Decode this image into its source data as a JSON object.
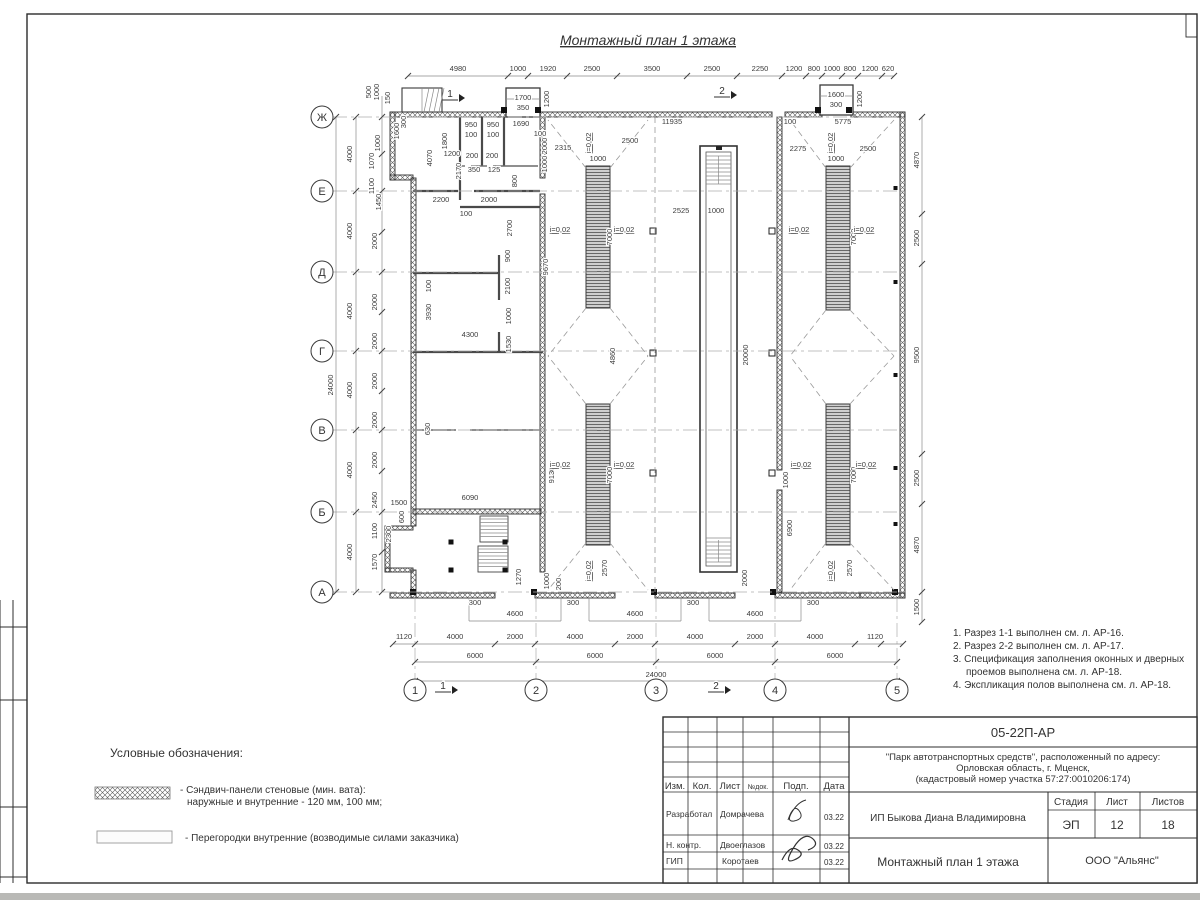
{
  "sheet": {
    "title": "Монтажный план 1 этажа"
  },
  "notes": {
    "lines": [
      "1. Разрез 1-1 выполнен см. л. АР-16.",
      "2. Разрез 2-2 выполнен см. л. АР-17.",
      "3. Спецификация заполнения оконных и дверных",
      "проемов выполнена см. л. АР-18.",
      "4. Экспликация полов выполнена см. л. АР-18."
    ]
  },
  "legend": {
    "heading": "Условные обозначения:",
    "item1_line1": "- Сэндвич-панели стеновые (мин. вата):",
    "item1_line2": "наружные и внутренние - 120 мм, 100 мм;",
    "item2": "- Перегородки внутренние (возводимые силами заказчика)"
  },
  "title_block": {
    "doc_number": "05-22П-АР",
    "project_line1": "\"Парк автотранспортных средств\",  расположенный по адресу:",
    "project_line2": "Орловская область, г. Мценск,",
    "project_line3": "(кадастровый номер участка 57:27:0010206:174)",
    "client": "ИП Быкова Диана Владимировна",
    "drawing_title": "Монтажный план 1 этажа",
    "company": "ООО \"Альянс\"",
    "col_izm": "Изм.",
    "col_kol": "Кол.",
    "col_list": "Лист",
    "col_ndok": "№док.",
    "col_podp": "Подп.",
    "col_data": "Дата",
    "row1_role": "Разработал",
    "row1_name": "Домрачева",
    "row1_date": "03.22",
    "row2_role": "Н. контр.",
    "row2_name": "Двоеглазов",
    "row2_date": "03.22",
    "row3_role": "ГИП",
    "row3_name": "Коротаев",
    "row3_date": "03.22",
    "stage_label": "Стадия",
    "sheet_label": "Лист",
    "sheets_label": "Листов",
    "stage_value": "ЭП",
    "sheet_value": "12",
    "sheets_value": "18"
  },
  "plan": {
    "slope_text": "i=0,02",
    "slope_h": [
      [
        560,
        232
      ],
      [
        624,
        232
      ],
      [
        799,
        232
      ],
      [
        864,
        232
      ],
      [
        560,
        467
      ],
      [
        624,
        467
      ],
      [
        801,
        467
      ],
      [
        866,
        467
      ]
    ],
    "slope_v": [
      [
        591,
        143
      ],
      [
        833,
        143
      ],
      [
        591,
        571
      ],
      [
        833,
        571
      ]
    ],
    "axes_left": [
      {
        "l": "Ж",
        "y": 117
      },
      {
        "l": "Е",
        "y": 191
      },
      {
        "l": "Д",
        "y": 272
      },
      {
        "l": "Г",
        "y": 351
      },
      {
        "l": "В",
        "y": 430
      },
      {
        "l": "Б",
        "y": 512
      },
      {
        "l": "А",
        "y": 592
      }
    ],
    "axes_bottom": [
      {
        "l": "1",
        "x": 415
      },
      {
        "l": "2",
        "x": 536
      },
      {
        "l": "3",
        "x": 656
      },
      {
        "l": "4",
        "x": 775
      },
      {
        "l": "5",
        "x": 897
      }
    ],
    "section_marks": [
      {
        "l": "1",
        "x": 450,
        "y": 97
      },
      {
        "l": "2",
        "x": 722,
        "y": 94
      },
      {
        "l": "1",
        "x": 443,
        "y": 689
      },
      {
        "l": "2",
        "x": 716,
        "y": 689
      }
    ],
    "dims": [
      {
        "t": "4980",
        "x": 458,
        "y": 71
      },
      {
        "t": "1000",
        "x": 518,
        "y": 71
      },
      {
        "t": "1920",
        "x": 548,
        "y": 71
      },
      {
        "t": "2500",
        "x": 592,
        "y": 71
      },
      {
        "t": "3500",
        "x": 652,
        "y": 71
      },
      {
        "t": "2500",
        "x": 712,
        "y": 71
      },
      {
        "t": "2250",
        "x": 760,
        "y": 71
      },
      {
        "t": "1200",
        "x": 794,
        "y": 71
      },
      {
        "t": "800",
        "x": 814,
        "y": 71
      },
      {
        "t": "1000",
        "x": 832,
        "y": 71
      },
      {
        "t": "800",
        "x": 850,
        "y": 71
      },
      {
        "t": "1200",
        "x": 870,
        "y": 71
      },
      {
        "t": "620",
        "x": 888,
        "y": 71
      },
      {
        "t": "1700",
        "x": 523,
        "y": 100
      },
      {
        "t": "350",
        "x": 523,
        "y": 110
      },
      {
        "t": "1200",
        "x": 549,
        "y": 99,
        "v": 1
      },
      {
        "t": "1600",
        "x": 836,
        "y": 97
      },
      {
        "t": "300",
        "x": 836,
        "y": 107
      },
      {
        "t": "1200",
        "x": 862,
        "y": 99,
        "v": 1
      },
      {
        "t": "500",
        "x": 371,
        "y": 92,
        "v": 1
      },
      {
        "t": "1000",
        "x": 379,
        "y": 92,
        "v": 1
      },
      {
        "t": "150",
        "x": 390,
        "y": 98,
        "v": 1
      },
      {
        "t": "1600",
        "x": 399,
        "y": 131,
        "v": 1
      },
      {
        "t": "300",
        "x": 406,
        "y": 122,
        "v": 1
      },
      {
        "t": "1000",
        "x": 380,
        "y": 143,
        "v": 1
      },
      {
        "t": "1070",
        "x": 374,
        "y": 161,
        "v": 1
      },
      {
        "t": "1100",
        "x": 374,
        "y": 186,
        "v": 1
      },
      {
        "t": "1450",
        "x": 381,
        "y": 202,
        "v": 1
      },
      {
        "t": "1200",
        "x": 452,
        "y": 156
      },
      {
        "t": "24000",
        "x": 333,
        "y": 385,
        "v": 1
      },
      {
        "t": "4000",
        "x": 352,
        "y": 154,
        "v": 1
      },
      {
        "t": "4000",
        "x": 352,
        "y": 231,
        "v": 1
      },
      {
        "t": "4000",
        "x": 352,
        "y": 311,
        "v": 1
      },
      {
        "t": "4000",
        "x": 352,
        "y": 390,
        "v": 1
      },
      {
        "t": "4000",
        "x": 352,
        "y": 470,
        "v": 1
      },
      {
        "t": "4000",
        "x": 352,
        "y": 552,
        "v": 1
      },
      {
        "t": "2000",
        "x": 377,
        "y": 241,
        "v": 1
      },
      {
        "t": "2000",
        "x": 377,
        "y": 302,
        "v": 1
      },
      {
        "t": "2000",
        "x": 377,
        "y": 341,
        "v": 1
      },
      {
        "t": "2000",
        "x": 377,
        "y": 381,
        "v": 1
      },
      {
        "t": "2000",
        "x": 377,
        "y": 420,
        "v": 1
      },
      {
        "t": "2000",
        "x": 377,
        "y": 460,
        "v": 1
      },
      {
        "t": "2450",
        "x": 377,
        "y": 500,
        "v": 1
      },
      {
        "t": "1100",
        "x": 377,
        "y": 531,
        "v": 1
      },
      {
        "t": "1570",
        "x": 377,
        "y": 562,
        "v": 1
      },
      {
        "t": "1500",
        "x": 399,
        "y": 505
      },
      {
        "t": "2300",
        "x": 391,
        "y": 534,
        "v": 1
      },
      {
        "t": "600",
        "x": 404,
        "y": 517,
        "v": 1
      },
      {
        "t": "4870",
        "x": 919,
        "y": 160,
        "v": 1
      },
      {
        "t": "2500",
        "x": 919,
        "y": 238,
        "v": 1
      },
      {
        "t": "9500",
        "x": 919,
        "y": 355,
        "v": 1
      },
      {
        "t": "2500",
        "x": 919,
        "y": 478,
        "v": 1
      },
      {
        "t": "4870",
        "x": 919,
        "y": 545,
        "v": 1
      },
      {
        "t": "1500",
        "x": 919,
        "y": 607,
        "v": 1
      },
      {
        "t": "300",
        "x": 475,
        "y": 605
      },
      {
        "t": "300",
        "x": 573,
        "y": 605
      },
      {
        "t": "300",
        "x": 693,
        "y": 605
      },
      {
        "t": "300",
        "x": 813,
        "y": 605
      },
      {
        "t": "4600",
        "x": 515,
        "y": 616
      },
      {
        "t": "4600",
        "x": 635,
        "y": 616
      },
      {
        "t": "4600",
        "x": 755,
        "y": 616
      },
      {
        "t": "1120",
        "x": 404,
        "y": 639
      },
      {
        "t": "4000",
        "x": 455,
        "y": 639
      },
      {
        "t": "2000",
        "x": 515,
        "y": 639
      },
      {
        "t": "4000",
        "x": 575,
        "y": 639
      },
      {
        "t": "2000",
        "x": 635,
        "y": 639
      },
      {
        "t": "4000",
        "x": 695,
        "y": 639
      },
      {
        "t": "2000",
        "x": 755,
        "y": 639
      },
      {
        "t": "4000",
        "x": 815,
        "y": 639
      },
      {
        "t": "1120",
        "x": 875,
        "y": 639
      },
      {
        "t": "6000",
        "x": 475,
        "y": 658
      },
      {
        "t": "6000",
        "x": 595,
        "y": 658
      },
      {
        "t": "6000",
        "x": 715,
        "y": 658
      },
      {
        "t": "6000",
        "x": 835,
        "y": 658
      },
      {
        "t": "24000",
        "x": 656,
        "y": 677
      },
      {
        "t": "11935",
        "x": 672,
        "y": 124
      },
      {
        "t": "100",
        "x": 790,
        "y": 124
      },
      {
        "t": "5775",
        "x": 843,
        "y": 124
      },
      {
        "t": "2315",
        "x": 563,
        "y": 150
      },
      {
        "t": "2500",
        "x": 630,
        "y": 143
      },
      {
        "t": "2275",
        "x": 798,
        "y": 151
      },
      {
        "t": "2500",
        "x": 868,
        "y": 151
      },
      {
        "t": "1000",
        "x": 598,
        "y": 161
      },
      {
        "t": "1000",
        "x": 836,
        "y": 161
      },
      {
        "t": "2525",
        "x": 681,
        "y": 213
      },
      {
        "t": "1000",
        "x": 716,
        "y": 213
      },
      {
        "t": "4860",
        "x": 615,
        "y": 356,
        "v": 1
      },
      {
        "t": "7000",
        "x": 612,
        "y": 237,
        "v": 1
      },
      {
        "t": "7000",
        "x": 612,
        "y": 475,
        "v": 1
      },
      {
        "t": "2570",
        "x": 607,
        "y": 568,
        "v": 1
      },
      {
        "t": "7000",
        "x": 856,
        "y": 237,
        "v": 1
      },
      {
        "t": "7000",
        "x": 856,
        "y": 475,
        "v": 1
      },
      {
        "t": "2570",
        "x": 852,
        "y": 568,
        "v": 1
      },
      {
        "t": "9130",
        "x": 554,
        "y": 475,
        "v": 1
      },
      {
        "t": "9670",
        "x": 548,
        "y": 267,
        "v": 1
      },
      {
        "t": "6900",
        "x": 792,
        "y": 528,
        "v": 1
      },
      {
        "t": "1000",
        "x": 788,
        "y": 480,
        "v": 1
      },
      {
        "t": "20000",
        "x": 748,
        "y": 355,
        "v": 1
      },
      {
        "t": "2000",
        "x": 747,
        "y": 578,
        "v": 1
      },
      {
        "t": "1270",
        "x": 521,
        "y": 577,
        "v": 1
      },
      {
        "t": "1000",
        "x": 549,
        "y": 581,
        "v": 1
      },
      {
        "t": "200",
        "x": 561,
        "y": 584,
        "v": 1
      },
      {
        "t": "6090",
        "x": 470,
        "y": 500
      },
      {
        "t": "4300",
        "x": 470,
        "y": 337
      },
      {
        "t": "2100",
        "x": 510,
        "y": 286,
        "v": 1
      },
      {
        "t": "1000",
        "x": 511,
        "y": 316,
        "v": 1
      },
      {
        "t": "1530",
        "x": 511,
        "y": 344,
        "v": 1
      },
      {
        "t": "900",
        "x": 510,
        "y": 256,
        "v": 1
      },
      {
        "t": "3930",
        "x": 431,
        "y": 312,
        "v": 1
      },
      {
        "t": "100",
        "x": 431,
        "y": 286,
        "v": 1
      },
      {
        "t": "630",
        "x": 430,
        "y": 429,
        "v": 1
      },
      {
        "t": "2200",
        "x": 441,
        "y": 202
      },
      {
        "t": "2000",
        "x": 489,
        "y": 202
      },
      {
        "t": "100",
        "x": 466,
        "y": 216
      },
      {
        "t": "2700",
        "x": 512,
        "y": 228,
        "v": 1
      },
      {
        "t": "800",
        "x": 517,
        "y": 181,
        "v": 1
      },
      {
        "t": "1800",
        "x": 447,
        "y": 141,
        "v": 1
      },
      {
        "t": "4070",
        "x": 432,
        "y": 158,
        "v": 1
      },
      {
        "t": "2170",
        "x": 461,
        "y": 171,
        "v": 1
      },
      {
        "t": "950",
        "x": 471,
        "y": 127
      },
      {
        "t": "950",
        "x": 493,
        "y": 127
      },
      {
        "t": "100",
        "x": 471,
        "y": 137
      },
      {
        "t": "100",
        "x": 493,
        "y": 137
      },
      {
        "t": "1690",
        "x": 521,
        "y": 126
      },
      {
        "t": "100",
        "x": 540,
        "y": 136
      },
      {
        "t": "2000",
        "x": 547,
        "y": 146,
        "v": 1
      },
      {
        "t": "200",
        "x": 472,
        "y": 158
      },
      {
        "t": "200",
        "x": 492,
        "y": 158
      },
      {
        "t": "350",
        "x": 474,
        "y": 172
      },
      {
        "t": "125",
        "x": 494,
        "y": 172
      },
      {
        "t": "1000",
        "x": 547,
        "y": 164,
        "v": 1
      }
    ]
  }
}
